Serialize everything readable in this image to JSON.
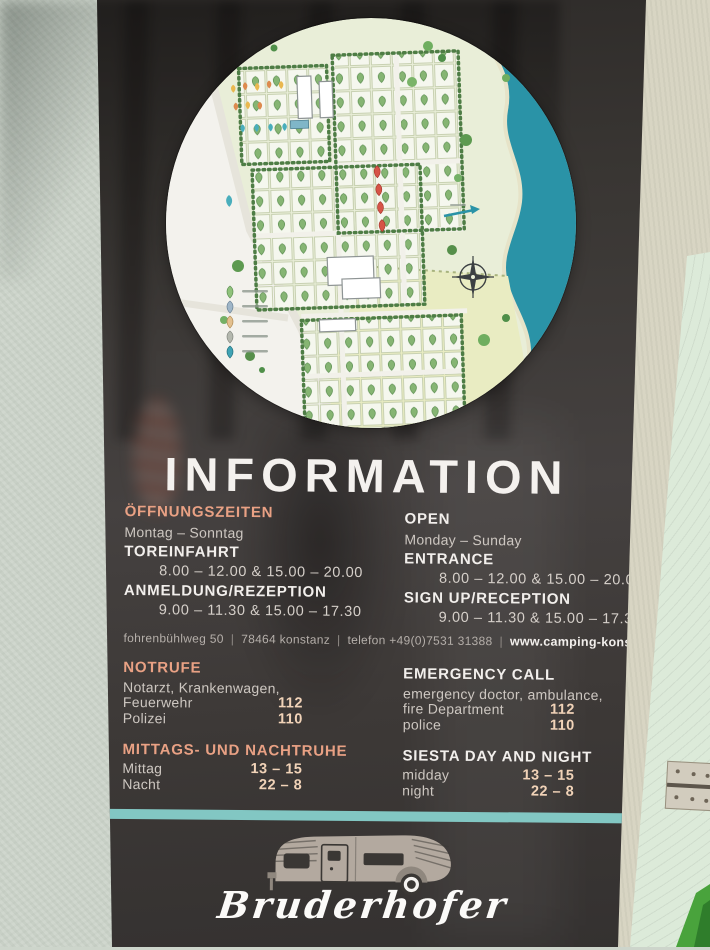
{
  "sign": {
    "title": "INFORMATION",
    "hours": {
      "de": {
        "heading": "ÖFFNUNGSZEITEN",
        "days": "Montag – Sonntag",
        "gate_label": "TOREINFAHRT",
        "gate_times": "8.00 – 12.00 & 15.00 – 20.00",
        "reception_label": "ANMELDUNG/REZEPTION",
        "reception_times": "9.00 – 11.30 & 15.00 – 17.30"
      },
      "en": {
        "heading": "OPEN",
        "days": "Monday – Sunday",
        "gate_label": "ENTRANCE",
        "gate_times": "8.00 – 12.00 & 15.00 – 20.00",
        "reception_label": "SIGN UP/RECEPTION",
        "reception_times": "9.00 – 11.30 & 15.00 – 17.30"
      }
    },
    "address": {
      "street": "fohrenbühlweg 50",
      "city": "78464 konstanz",
      "phone": "telefon +49(0)7531 31388",
      "divider": "|",
      "website": "www.camping-konstanz.de"
    },
    "emergency": {
      "de": {
        "heading": "NOTRUFE",
        "line1": "Notarzt, Krankenwagen,",
        "row1_label": "Feuerwehr",
        "row1_value": "112",
        "row2_label": "Polizei",
        "row2_value": "110"
      },
      "en": {
        "heading": "EMERGENCY CALL",
        "line1": "emergency doctor, ambulance,",
        "row1_label": "fire Department",
        "row1_value": "112",
        "row2_label": "police",
        "row2_value": "110"
      }
    },
    "quiet": {
      "de": {
        "heading": "MITTAGS- UND NACHTRUHE",
        "row1_label": "Mittag",
        "row1_value": "13 – 15",
        "row2_label": "Nacht",
        "row2_value": "22 – 8"
      },
      "en": {
        "heading": "SIESTA DAY AND NIGHT",
        "row1_label": "midday",
        "row1_value": "13 – 15",
        "row2_label": "night",
        "row2_value": "22 – 8"
      }
    },
    "logo": {
      "brand": "Bruderhofer"
    },
    "colors": {
      "accent_orange": "#e9a184",
      "teal_stripe": "#82c7c3",
      "sign_background": "#3a3734",
      "text_white": "#f2efec",
      "value_peach": "#f1d3b8"
    }
  },
  "map": {
    "type": "campground-site-plan",
    "colors": {
      "ground": "#e9eed8",
      "lake": "#2a93a7",
      "field": "#e9ecc2",
      "road_area": "#f3f2ed",
      "hedge": "#4e7d45"
    },
    "legend_pin_colors": [
      "#8fc27b",
      "#9fb6c8",
      "#e3c08e",
      "#b4b8ae",
      "#3fa3b4"
    ],
    "marker_colors": {
      "standard_pitch": "#86b573",
      "tent_row": "#e9b850",
      "highlight_pins": "#d65447",
      "water_pins": "#49aebc"
    }
  }
}
